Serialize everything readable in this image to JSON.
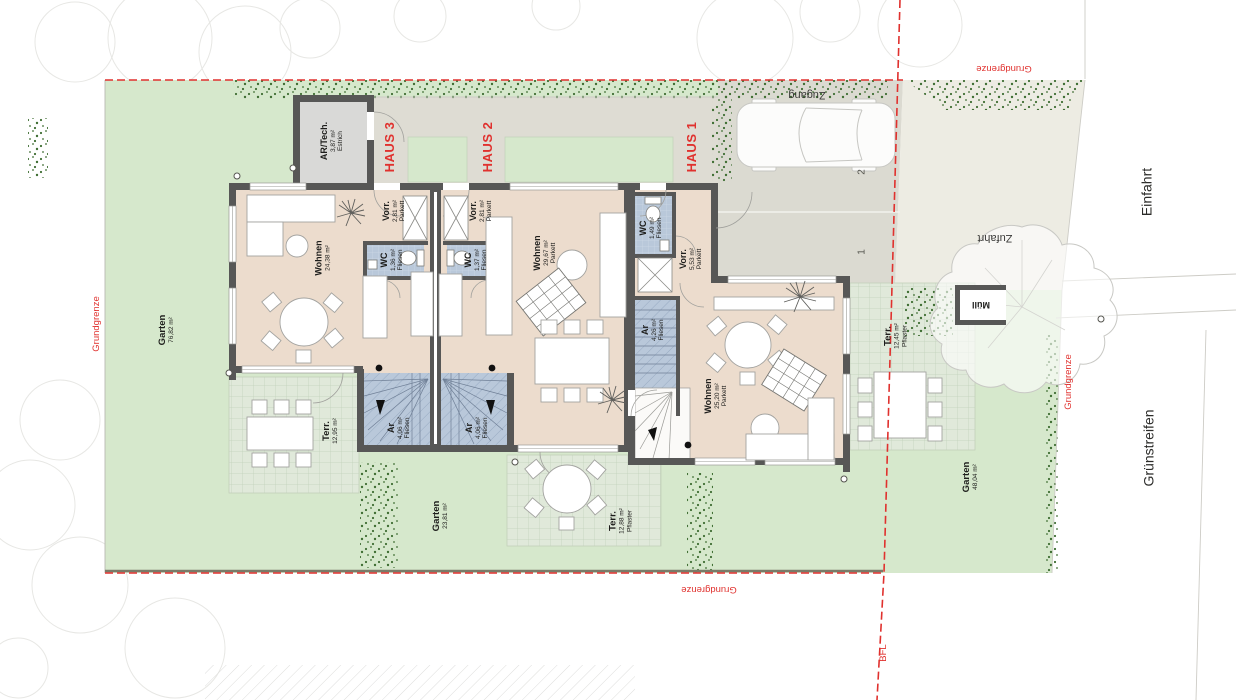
{
  "colors": {
    "boundary_red": "#e0312e",
    "garden_green": "#d6e8cc",
    "terrace_green": "#e0e9da",
    "pavement_gray": "#dbdad1",
    "zufahrt_beige": "#edece3",
    "floor_tan": "#ecdccd",
    "wet_room_blue": "#b9c8da",
    "wall_dark": "#575756",
    "hedge_green": "#3f6e33",
    "text_dark": "#1d1d1b"
  },
  "site_labels": {
    "zugang": "Zugang",
    "zufahrt": "Zufahrt",
    "einfahrt": "Einfahrt",
    "gruenstreifen": "Grünstreifen",
    "muell": "Müll",
    "grundgrenze_top": "Grundgrenze",
    "grundgrenze_left": "Grundgrenze",
    "grundgrenze_right": "Grundgrenze",
    "grundgrenze_bottom": "Grundgrenze",
    "bfl": "BFL"
  },
  "parking": {
    "space_1": "1",
    "space_2": "2"
  },
  "houses": [
    {
      "label": "HAUS 1",
      "rooms": [
        {
          "name": "Vorr.",
          "area": "5,53 m²",
          "floor": "Parkett"
        },
        {
          "name": "WC",
          "area": "1,49 m²",
          "floor": "Fliesen"
        },
        {
          "name": "Ar",
          "area": "4,26 m²",
          "floor": "Fliesen"
        },
        {
          "name": "Wohnen",
          "area": "25,20 m²",
          "floor": "Parkett"
        }
      ]
    },
    {
      "label": "HAUS 2",
      "rooms": [
        {
          "name": "Vorr.",
          "area": "2,81 m²",
          "floor": "Parkett"
        },
        {
          "name": "WC",
          "area": "1,37 m²",
          "floor": "Fliesen"
        },
        {
          "name": "Wohnen",
          "area": "29,67 m²",
          "floor": "Parkett"
        },
        {
          "name": "Ar",
          "area": "4,06 m²",
          "floor": "Fliesen"
        }
      ]
    },
    {
      "label": "HAUS 3",
      "rooms": [
        {
          "name": "AR/Tech.",
          "area": "3,87 m²",
          "floor": "Estrich"
        },
        {
          "name": "Vorr.",
          "area": "2,81 m²",
          "floor": "Parkett"
        },
        {
          "name": "WC",
          "area": "1,36 m²",
          "floor": "Fliesen"
        },
        {
          "name": "Wohnen",
          "area": "24,38 m²"
        },
        {
          "name": "Ar",
          "area": "4,06 m²",
          "floor": "Fliesen"
        }
      ]
    }
  ],
  "outdoor": [
    {
      "name": "Garten",
      "area": "76,82 m²"
    },
    {
      "name": "Terr.",
      "area": "12,95 m²"
    },
    {
      "name": "Garten",
      "area": "23,81 m²"
    },
    {
      "name": "Terr.",
      "area": "12,88 m²",
      "floor": "Pflaster"
    },
    {
      "name": "Terr.",
      "area": "12,45 m²",
      "floor": "Pflaster"
    },
    {
      "name": "Garten",
      "area": "48,04 m²"
    }
  ]
}
